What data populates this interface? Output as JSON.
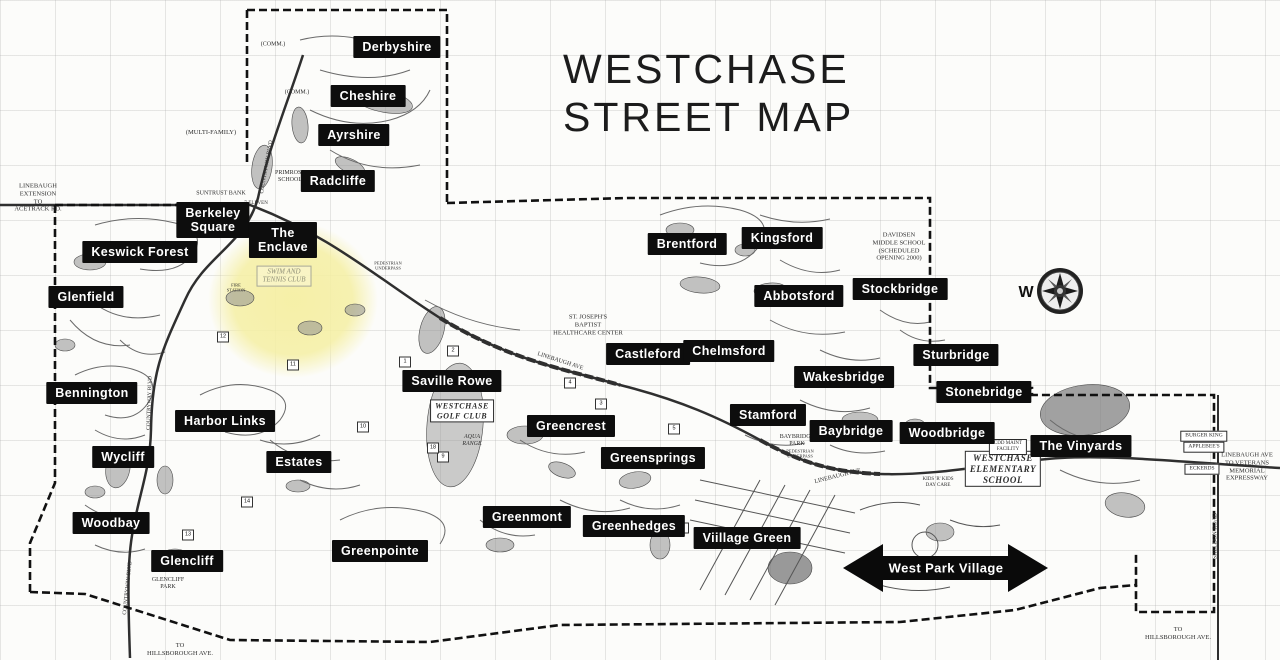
{
  "title": {
    "line1": "WESTCHASE",
    "line2": "STREET MAP"
  },
  "compass": {
    "label": "W"
  },
  "arrow": {
    "label": "West Park Village",
    "x": 946,
    "y": 568
  },
  "colors": {
    "label_bg": "#0d0d0d",
    "label_text": "#ffffff",
    "highlight_yellow": "#f5efa3",
    "map_ink": "#2d2d2d",
    "grid_line": "#aaaaaa"
  },
  "neighborhoods": [
    {
      "id": "derbyshire",
      "text": "Derbyshire",
      "x": 397,
      "y": 47
    },
    {
      "id": "cheshire",
      "text": "Cheshire",
      "x": 368,
      "y": 96
    },
    {
      "id": "ayrshire",
      "text": "Ayrshire",
      "x": 354,
      "y": 135
    },
    {
      "id": "radcliffe",
      "text": "Radcliffe",
      "x": 338,
      "y": 181
    },
    {
      "id": "berkeley-square",
      "text": "Berkeley\nSquare",
      "x": 213,
      "y": 220
    },
    {
      "id": "the-enclave",
      "text": "The\nEnclave",
      "x": 283,
      "y": 240
    },
    {
      "id": "keswick-forest",
      "text": "Keswick Forest",
      "x": 140,
      "y": 252
    },
    {
      "id": "glenfield",
      "text": "Glenfield",
      "x": 86,
      "y": 297
    },
    {
      "id": "bennington",
      "text": "Bennington",
      "x": 92,
      "y": 393
    },
    {
      "id": "harbor-links",
      "text": "Harbor Links",
      "x": 225,
      "y": 421
    },
    {
      "id": "wycliff",
      "text": "Wycliff",
      "x": 123,
      "y": 457
    },
    {
      "id": "estates",
      "text": "Estates",
      "x": 299,
      "y": 462
    },
    {
      "id": "saville-rowe",
      "text": "Saville Rowe",
      "x": 452,
      "y": 381
    },
    {
      "id": "woodbay",
      "text": "Woodbay",
      "x": 111,
      "y": 523
    },
    {
      "id": "glencliff",
      "text": "Glencliff",
      "x": 187,
      "y": 561
    },
    {
      "id": "greenpointe",
      "text": "Greenpointe",
      "x": 380,
      "y": 551
    },
    {
      "id": "greencrest",
      "text": "Greencrest",
      "x": 571,
      "y": 426
    },
    {
      "id": "greensprings",
      "text": "Greensprings",
      "x": 653,
      "y": 458
    },
    {
      "id": "greenmont",
      "text": "Greenmont",
      "x": 527,
      "y": 517
    },
    {
      "id": "greenhedges",
      "text": "Greenhedges",
      "x": 634,
      "y": 526
    },
    {
      "id": "village-green",
      "text": "Viillage Green",
      "x": 747,
      "y": 538
    },
    {
      "id": "brentford",
      "text": "Brentford",
      "x": 687,
      "y": 244
    },
    {
      "id": "kingsford",
      "text": "Kingsford",
      "x": 782,
      "y": 238
    },
    {
      "id": "abbotsford",
      "text": "Abbotsford",
      "x": 799,
      "y": 296
    },
    {
      "id": "stockbridge",
      "text": "Stockbridge",
      "x": 900,
      "y": 289
    },
    {
      "id": "castleford",
      "text": "Castleford",
      "x": 648,
      "y": 354
    },
    {
      "id": "chelmsford",
      "text": "Chelmsford",
      "x": 729,
      "y": 351
    },
    {
      "id": "sturbridge",
      "text": "Sturbridge",
      "x": 956,
      "y": 355
    },
    {
      "id": "wakesbridge",
      "text": "Wakesbridge",
      "x": 844,
      "y": 377
    },
    {
      "id": "stonebridge",
      "text": "Stonebridge",
      "x": 984,
      "y": 392
    },
    {
      "id": "stamford",
      "text": "Stamford",
      "x": 768,
      "y": 415
    },
    {
      "id": "baybridge",
      "text": "Baybridge",
      "x": 851,
      "y": 431
    },
    {
      "id": "woodbridge",
      "text": "Woodbridge",
      "x": 947,
      "y": 433
    },
    {
      "id": "the-vinyards",
      "text": "The Vinyards",
      "x": 1081,
      "y": 446
    }
  ],
  "map_texts": [
    {
      "id": "comm-1",
      "text": "(COMM.)",
      "x": 273,
      "y": 45,
      "size": 6
    },
    {
      "id": "comm-2",
      "text": "(COMM.)",
      "x": 297,
      "y": 93,
      "size": 6
    },
    {
      "id": "multi-family",
      "text": "(MULTI-FAMILY)",
      "x": 211,
      "y": 133,
      "size": 6.5
    },
    {
      "id": "primrose-school",
      "text": "PRIMROSE\nSCHOOL",
      "x": 290,
      "y": 177,
      "size": 6
    },
    {
      "id": "suntrust-bank",
      "text": "SUNTRUST BANK",
      "x": 221,
      "y": 194,
      "size": 6
    },
    {
      "id": "seven-eleven",
      "text": "7-ELEVEN",
      "x": 256,
      "y": 204,
      "size": 5
    },
    {
      "id": "linebaugh-extension",
      "text": "LINEBAUGH\nEXTENSION\nTO\nACETRACK RD.",
      "x": 38,
      "y": 198,
      "size": 6.5
    },
    {
      "id": "swim-tennis-club",
      "text": "SWIM AND\nTENNIS CLUB",
      "x": 284,
      "y": 276,
      "size": 7,
      "cls": "lightbox ital"
    },
    {
      "id": "fire-station",
      "text": "FIRE\nSTATION",
      "x": 236,
      "y": 288,
      "size": 4.5
    },
    {
      "id": "westchase-golf-club",
      "text": "WESTCHASE\nGOLF CLUB",
      "x": 462,
      "y": 411,
      "size": 8,
      "cls": "boxed boldital"
    },
    {
      "id": "aqua-range",
      "text": "AQUA\nRANGE",
      "x": 472,
      "y": 441,
      "size": 6,
      "cls": "ital"
    },
    {
      "id": "st-josephs",
      "text": "ST. JOSEPH'S\nBAPTIST\nHEALTHCARE CENTER",
      "x": 588,
      "y": 325,
      "size": 6.5
    },
    {
      "id": "davidsen-school",
      "text": "DAVIDSEN\nMIDDLE SCHOOL\n(SCHEDULED\nOPENING 2000)",
      "x": 899,
      "y": 247,
      "size": 6.5
    },
    {
      "id": "baybridge-park",
      "text": "BAYBRIDGE\nPARK",
      "x": 797,
      "y": 441,
      "size": 6
    },
    {
      "id": "ped-underpass-1",
      "text": "PEDESTRIAN\nUNDERPASS",
      "x": 800,
      "y": 454,
      "size": 4.5
    },
    {
      "id": "ped-underpass-2",
      "text": "PEDESTRIAN\nUNDERPASS",
      "x": 388,
      "y": 266,
      "size": 4.5
    },
    {
      "id": "westchase-elem",
      "text": "WESTCHASE\nELEMENTARY\nSCHOOL",
      "x": 1003,
      "y": 469,
      "size": 9,
      "cls": "boxed boldital"
    },
    {
      "id": "park",
      "text": "PARK",
      "x": 981,
      "y": 444,
      "size": 5
    },
    {
      "id": "cdd-maint",
      "text": "CDD MAINT\nFACILITY",
      "x": 1008,
      "y": 447,
      "size": 5,
      "cls": "boxed"
    },
    {
      "id": "kids-r-kids",
      "text": "KIDS 'R' KIDS\nDAY CARE",
      "x": 938,
      "y": 483,
      "size": 5
    },
    {
      "id": "burger-king",
      "text": "BURGER KING",
      "x": 1204,
      "y": 436,
      "size": 5.5,
      "cls": "boxed"
    },
    {
      "id": "applebees",
      "text": "APPLEBEE'S",
      "x": 1204,
      "y": 447,
      "size": 5.5,
      "cls": "boxed"
    },
    {
      "id": "eckerds",
      "text": "ECKERDS",
      "x": 1202,
      "y": 469,
      "size": 5.5,
      "cls": "boxed"
    },
    {
      "id": "linebaugh-veterans",
      "text": "LINEBAUGH AVE\nTO VETERANS\nMEMORIAL\nEXPRESSWAY",
      "x": 1247,
      "y": 467,
      "size": 6.5
    },
    {
      "id": "glencliff-park",
      "text": "GLENCLIFF\nPARK",
      "x": 168,
      "y": 584,
      "size": 6
    },
    {
      "id": "to-hillsborough-sw",
      "text": "TO\nHILLSBOROUGH AVE.",
      "x": 180,
      "y": 650,
      "size": 6.5
    },
    {
      "id": "to-hillsborough-se",
      "text": "TO\nHILLSBOROUGH AVE.",
      "x": 1178,
      "y": 634,
      "size": 6.5
    },
    {
      "id": "countryway-blvd-1",
      "text": "COUNTRYWAY BLVD",
      "x": 267,
      "y": 167,
      "size": 5.5,
      "rot": -80
    },
    {
      "id": "countryway-blvd-2",
      "text": "COUNTRYWAY BLVD",
      "x": 150,
      "y": 403,
      "size": 5.5,
      "rot": -88
    },
    {
      "id": "countryway-blvd-3",
      "text": "COUNTRYWAY BLVD",
      "x": 128,
      "y": 588,
      "size": 5.5,
      "rot": -84
    },
    {
      "id": "linebaugh-ave-1",
      "text": "LINEBAUGH AVE",
      "x": 560,
      "y": 362,
      "size": 6,
      "rot": 18
    },
    {
      "id": "linebaugh-ave-2",
      "text": "LINEBAUGH AVE",
      "x": 838,
      "y": 477,
      "size": 6,
      "rot": -14
    },
    {
      "id": "sheldon-road",
      "text": "SHELDON ROAD",
      "x": 1216,
      "y": 536,
      "size": 6,
      "rot": -90
    }
  ],
  "hole_markers": [
    {
      "n": "1",
      "x": 405,
      "y": 362
    },
    {
      "n": "2",
      "x": 453,
      "y": 351
    },
    {
      "n": "3",
      "x": 601,
      "y": 404
    },
    {
      "n": "4",
      "x": 570,
      "y": 383
    },
    {
      "n": "5",
      "x": 674,
      "y": 429
    },
    {
      "n": "6",
      "x": 683,
      "y": 528
    },
    {
      "n": "9",
      "x": 443,
      "y": 457
    },
    {
      "n": "10",
      "x": 363,
      "y": 427
    },
    {
      "n": "11",
      "x": 293,
      "y": 365
    },
    {
      "n": "12",
      "x": 223,
      "y": 337
    },
    {
      "n": "13",
      "x": 188,
      "y": 535
    },
    {
      "n": "14",
      "x": 247,
      "y": 502
    },
    {
      "n": "18",
      "x": 433,
      "y": 448
    }
  ]
}
